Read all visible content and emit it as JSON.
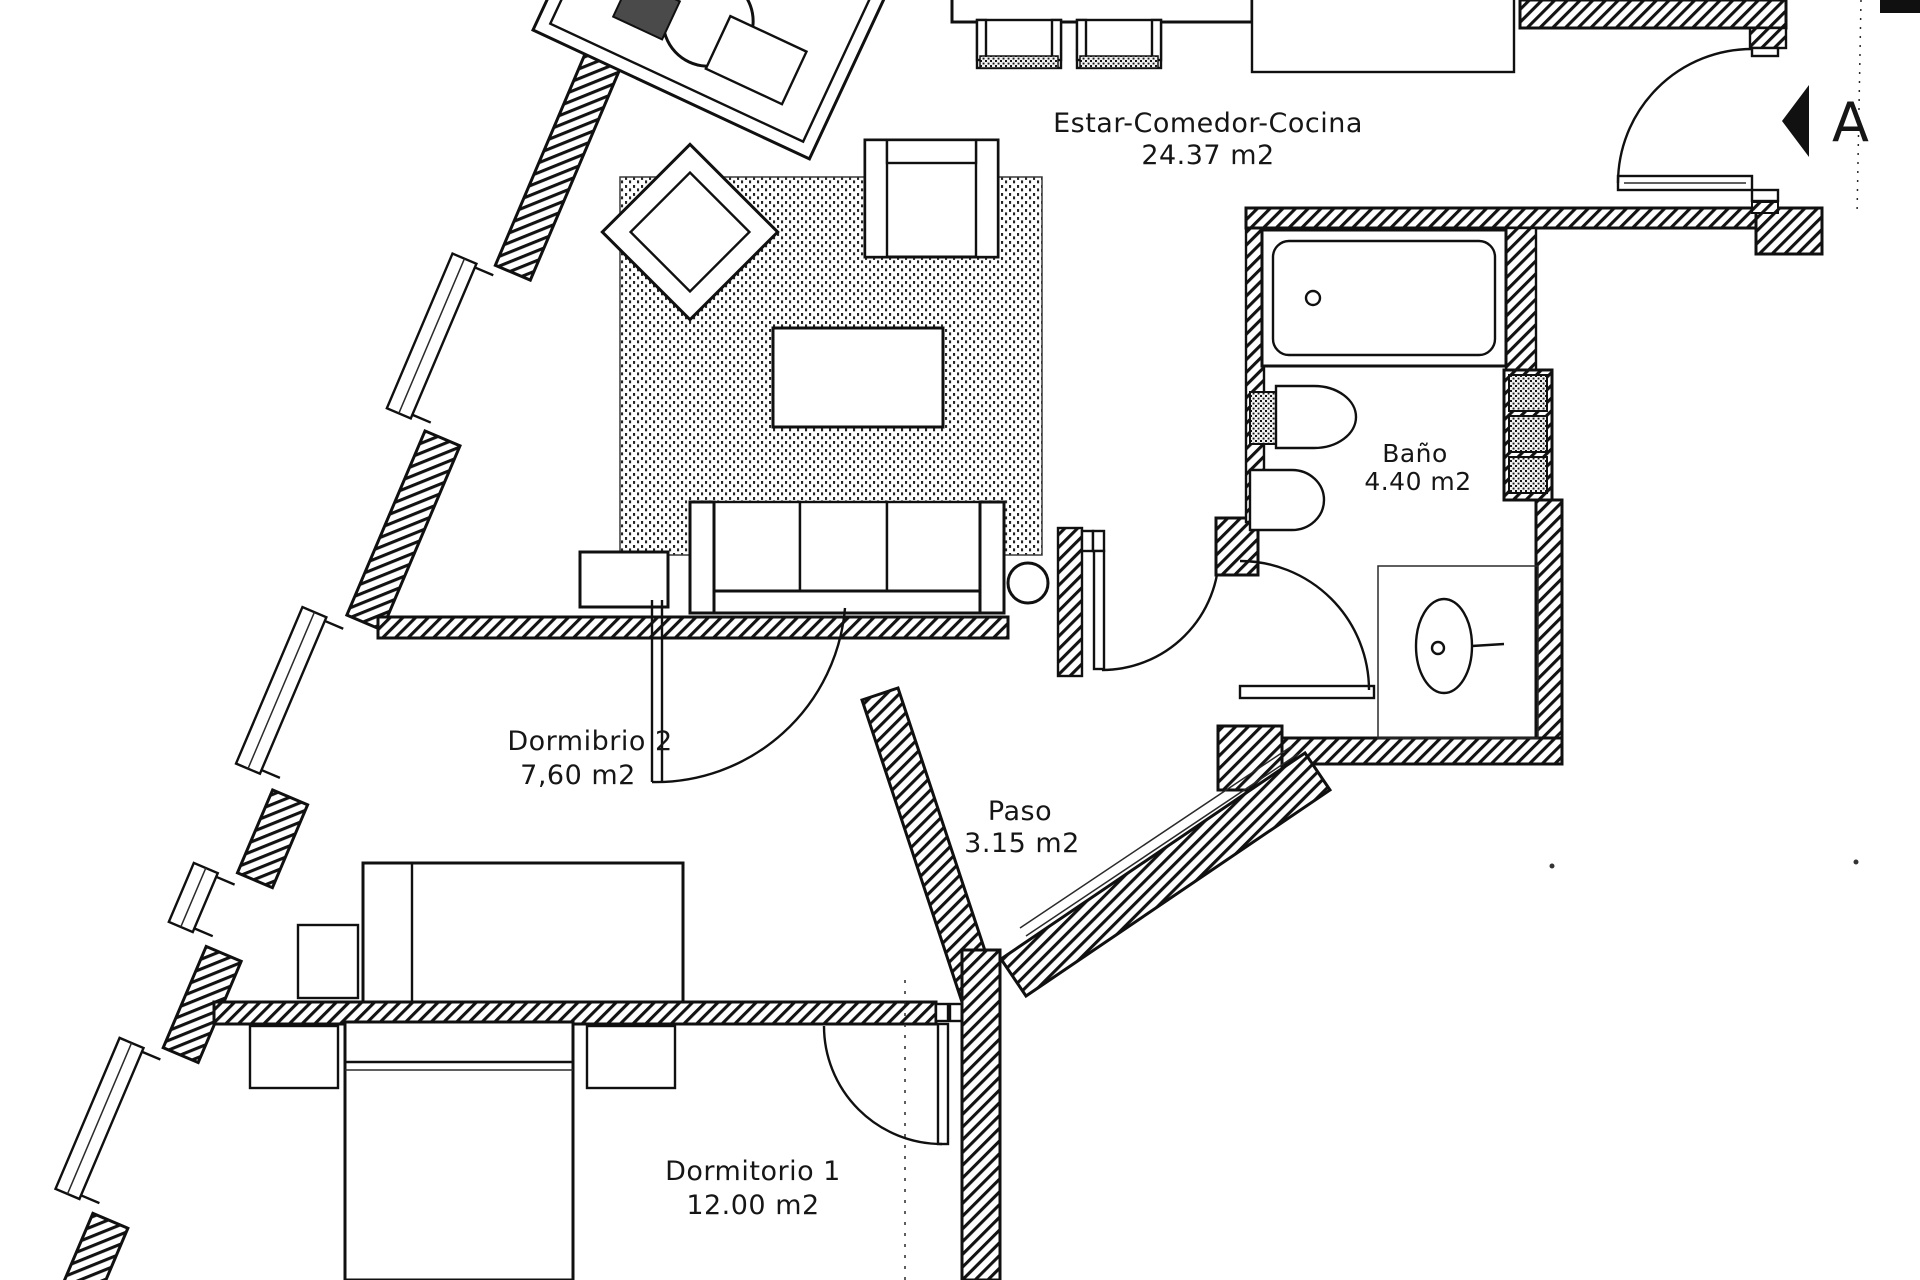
{
  "plan": {
    "rooms": [
      {
        "id": "estar-comedor-cocina",
        "name": "Estar-Comedor-Cocina",
        "area": "24.37 m2"
      },
      {
        "id": "bano",
        "name": "Baño",
        "area": "4.40 m2"
      },
      {
        "id": "dormitorio-2",
        "name": "Dormibrio 2",
        "area": "7,60 m2"
      },
      {
        "id": "paso",
        "name": "Paso",
        "area": "3.15 m2"
      },
      {
        "id": "dormitorio-1",
        "name": "Dormitorio 1",
        "area": "12.00 m2"
      }
    ],
    "marker": {
      "letter": "A"
    },
    "colors": {
      "ink": "#101010",
      "paper": "#ffffff"
    }
  }
}
